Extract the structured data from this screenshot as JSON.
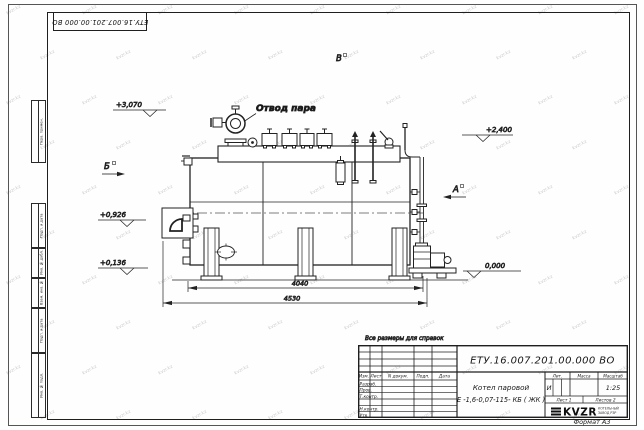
{
  "watermark": {
    "text": "kvzr.kz"
  },
  "top_stamp": {
    "doc_number": "ЕТУ.16.007.201.00.000  ВО"
  },
  "margin_boxes": {
    "perv_primen": "Перв. примен.",
    "podp_data_1": "Подп. и дата",
    "inv_dubl": "Инв. № дубл.",
    "vzam_inv": "Взам. инв. №",
    "podp_data_2": "Подп. и дата",
    "inv_podl": "Инв. № подл."
  },
  "drawing": {
    "note": "Все размеры для справок",
    "steam_outlet_label": "Отвод пара",
    "view_b": "Б",
    "view_v": "В",
    "view_a": "А",
    "elev_top": "+3,070",
    "elev_right": "+2,400",
    "elev_burner": "+0,926",
    "elev_low": "+0,136",
    "elev_zero": "0,000",
    "dim_inner": "4040",
    "dim_outer": "4530"
  },
  "title_block": {
    "doc_number": "ЕТУ.16.007.201.00.000  ВО",
    "product_line1": "Котел паровой",
    "product_line2": "Е -1,6-0,07-115- КБ ( ЖК )",
    "col_izm": "Изм.",
    "col_list": "Лист",
    "col_ndoc": "N докум.",
    "col_podp": "Подп.",
    "col_data": "Дата",
    "row_razrab": "Разраб.",
    "row_prov": "Пров.",
    "row_tkontr": "Т.контр.",
    "row_nkontr": "Н.контр.",
    "row_utv": "Утв.",
    "lit_header": "Лит.",
    "mass_header": "Масса",
    "scale_header": "Масштаб",
    "lit_value": "И",
    "scale_value": "1:25",
    "sheet_text": "Лист 1",
    "sheets_text": "Листов 2",
    "logo_text": "KVZR",
    "company_line1": "КОТЕЛЬНЫЙ",
    "company_line2": "ЗАВОД РЗР",
    "format_label": "Формат А3"
  }
}
